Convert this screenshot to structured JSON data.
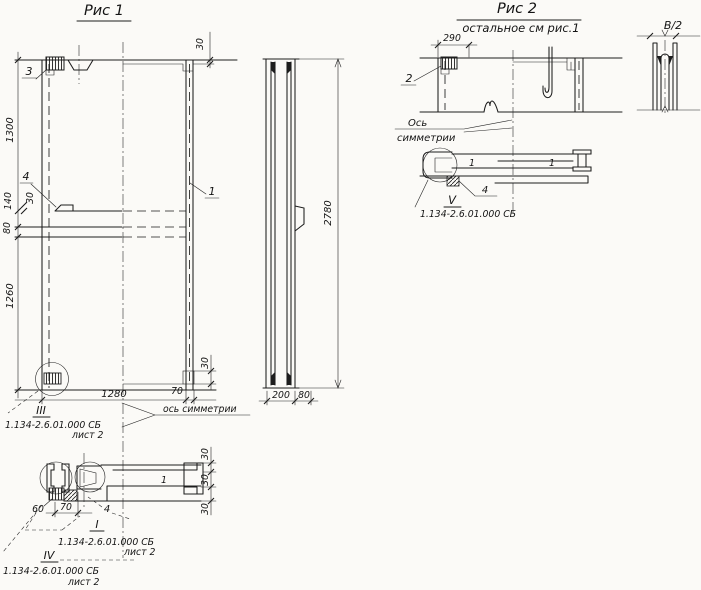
{
  "drawing": {
    "fig1": {
      "title": "Рис 1",
      "axis_label": "ось симметрии",
      "dim_1300": "1300",
      "dim_140": "140",
      "dim_30_notch": "30",
      "dim_80": "80",
      "dim_1260": "1260",
      "dim_30_top": "30",
      "dim_30_corner": "30",
      "dim_1280": "1280",
      "dim_70": "70",
      "label_1": "1",
      "label_3": "3",
      "label_4": "4"
    },
    "fig1_section": {
      "mark_1": "1",
      "dim_60": "60",
      "dim_70": "70",
      "label_4": "4",
      "dim_30_a": "30",
      "dim_30_b": "30",
      "dim_30_c": "30"
    },
    "side_view": {
      "dim_2780": "2780",
      "dim_200": "200",
      "dim_80": "80"
    },
    "fig2": {
      "title": "Рис 2",
      "subtitle": "остальное см рис.1",
      "dim_290": "290",
      "label_2": "2",
      "label_4": "4",
      "axis_line1": "Ось",
      "axis_line2": "симметрии",
      "mark_1_a": "1",
      "mark_1_b": "1"
    },
    "detail_b2": {
      "dim": "В/2"
    },
    "callouts": {
      "c3": {
        "mark": "III",
        "ref": "1.134-2.6.01.000 СБ",
        "sheet": "лист 2"
      },
      "c1": {
        "mark": "I",
        "ref": "1.134-2.6.01.000 СБ",
        "sheet": "лист 2"
      },
      "c4": {
        "mark": "IV",
        "ref": "1.134-2.6.01.000 СБ",
        "sheet": "лист 2"
      },
      "c5": {
        "mark": "V",
        "ref": "1.134-2.6.01.000 СБ"
      }
    }
  }
}
